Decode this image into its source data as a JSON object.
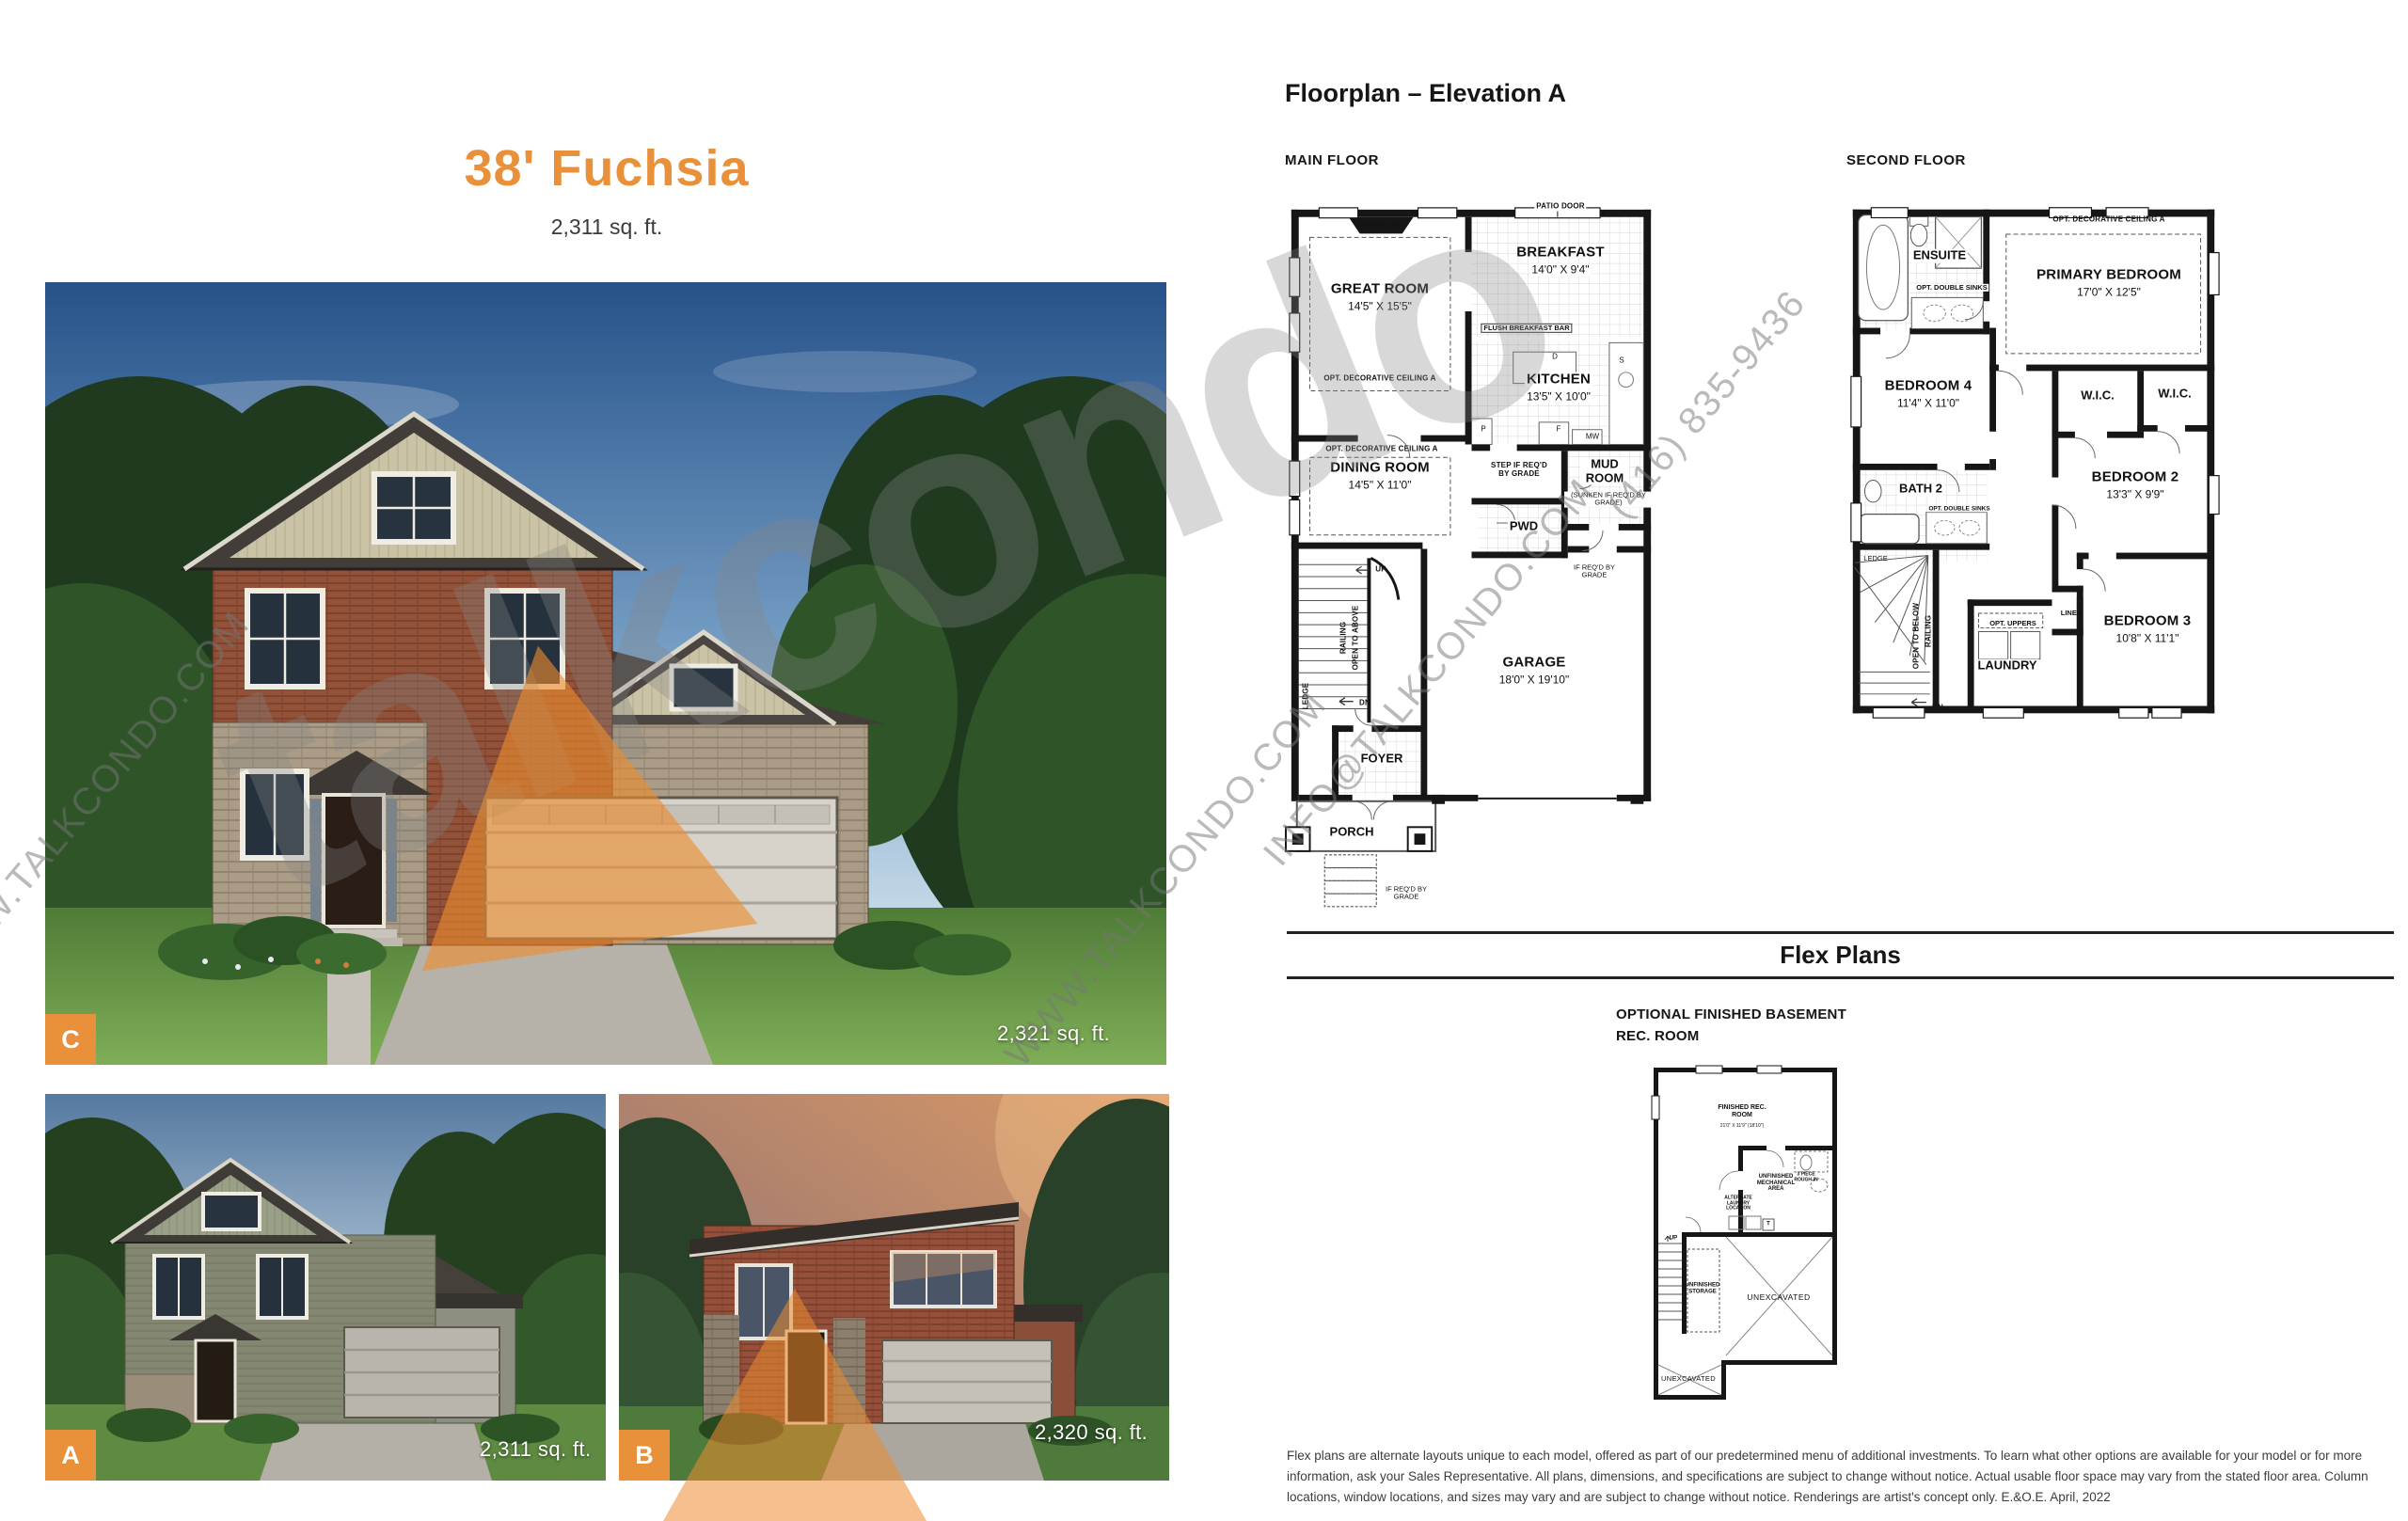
{
  "accent": "#E8913A",
  "header": {
    "title": "38' Fuchsia",
    "subtitle": "2,311 sq. ft."
  },
  "floorplan": {
    "heading": "Floorplan – Elevation A",
    "main_floor": {
      "label": "MAIN FLOOR",
      "fireplace": "FIREPLACE",
      "great_room": "GREAT ROOM",
      "great_room_dims": "14'5\" X 15'5\"",
      "opt_ceiling": "OPT. DECORATIVE CEILING A",
      "patio_door": "PATIO DOOR",
      "breakfast": "BREAKFAST",
      "breakfast_dims": "14'0\" X 9'4\"",
      "flush_breakfast_bar": "FLUSH BREAKFAST BAR",
      "kitchen": "KITCHEN",
      "kitchen_dims": "13'5\" X 10'0\"",
      "dining_room": "DINING ROOM",
      "dining_room_dims": "14'5\" X 11'0\"",
      "step_if_reqd": "STEP IF REQ'D BY GRADE",
      "mud_room": "MUD ROOM",
      "mud_room_note": "(SUNKEN IF REQ'D BY GRADE)",
      "pwd": "PWD",
      "if_reqd_by_grade": "IF REQ'D BY GRADE",
      "garage": "GARAGE",
      "garage_dims": "18'0\" X 19'10\"",
      "up": "UP",
      "dn": "DN",
      "railing": "RAILING",
      "open_to_above": "OPEN TO ABOVE",
      "ledge": "LEDGE",
      "foyer": "FOYER",
      "porch": "PORCH",
      "appl_d": "D",
      "appl_s": "S",
      "appl_p": "P",
      "appl_f": "F",
      "appl_mw": "MW"
    },
    "second_floor": {
      "label": "SECOND FLOOR",
      "ensuite": "ENSUITE",
      "opt_double_sinks": "OPT. DOUBLE SINKS",
      "opt_ceiling": "OPT. DECORATIVE CEILING A",
      "primary_bedroom": "PRIMARY BEDROOM",
      "primary_bedroom_dims": "17'0\" X 12'5\"",
      "bedroom4": "BEDROOM 4",
      "bedroom4_dims": "11'4\" X 11'0\"",
      "wic": "W.I.C.",
      "bath2": "BATH 2",
      "bedroom2": "BEDROOM 2",
      "bedroom2_dims": "13'3\" X 9'9\"",
      "bedroom3": "BEDROOM 3",
      "bedroom3_dims": "10'8\" X 11'1\"",
      "ledge": "LEDGE",
      "open_to_below": "OPEN TO BELOW",
      "railing": "RAILING",
      "dn": "DN",
      "laundry": "LAUNDRY",
      "opt_uppers": "OPT. UPPERS",
      "linen": "LINEN"
    },
    "flex": {
      "heading": "Flex Plans",
      "basement_caption": "OPTIONAL FINISHED BASEMENT REC. ROOM",
      "finished_rec": "FINISHED REC. ROOM",
      "finished_rec_dims": "21'0\" X 11'9\" (18'10\")",
      "mechanical": "UNFINISHED MECHANICAL AREA",
      "rough_in": "3 PIECE ROUGH-IN",
      "alt_laundry": "ALTERNATE LAUNDRY LOCATION",
      "tank": "T",
      "up": "UP",
      "storage": "UNFINISHED STORAGE",
      "unexcavated": "UNEXCAVATED"
    }
  },
  "elevations": {
    "c": {
      "id": "C",
      "sqft": "2,321 sq. ft."
    },
    "a": {
      "id": "A",
      "sqft": "2,311 sq. ft."
    },
    "b": {
      "id": "B",
      "sqft": "2,320 sq. ft."
    }
  },
  "watermark": {
    "brand": "talkcondo",
    "phone": "(416) 835-9436",
    "email": "INFO@TALKCONDO.COM",
    "website": "WWW.TALKCONDO.COM"
  },
  "disclaimer": "Flex plans are alternate layouts unique to each model, offered as part of our predetermined menu of additional investments. To learn what other options are available for your model or for more information, ask your Sales Representative. All plans, dimensions, and specifications are subject to change without notice. Actual usable floor space may vary from the stated floor area. Column locations, window locations, and sizes may vary and are subject to change without notice. Renderings are artist's concept only. E.&O.E. April, 2022"
}
